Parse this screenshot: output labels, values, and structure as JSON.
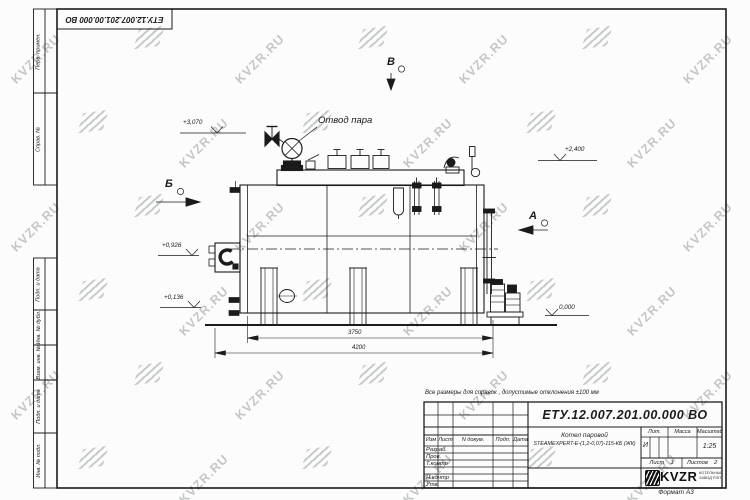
{
  "sheet": {
    "watermark_text": "KVZR.RU",
    "format_label": "Формат  А3"
  },
  "top_stamp": {
    "doc_number": "ЕТУ.12.007.201.00.000  ВО"
  },
  "margin": {
    "labels": [
      "Перв. примен.",
      "Справ. №",
      "Подп. и дата",
      "Инв. № дубл.",
      "Взам. инв. №",
      "Подп. и дата",
      "Инв. № подл."
    ]
  },
  "drawing": {
    "steam_outlet_label": "Отвод пара",
    "elevations": {
      "top": "+3,070",
      "right_top": "+2,400",
      "mid": "+0,926",
      "low": "+0,136",
      "zero": "0,000"
    },
    "dimensions": {
      "inner": "3750",
      "overall": "4200"
    },
    "views": {
      "b": "Б",
      "v": "В",
      "a": "А"
    }
  },
  "note": "Все размеры для справок , допустимые отклонения  ±100  мм",
  "title_block": {
    "doc_number": "ЕТУ.12.007.201.00.000  ВО",
    "rev_headers": [
      "Изм",
      "Лист",
      "N докум.",
      "Подп.",
      "Дата"
    ],
    "row_labels": [
      "Разраб.",
      "Пров.",
      "Т.контр",
      "Н.контр",
      "Утв."
    ],
    "product_name_line1": "Котел паровой",
    "product_name_line2": "STEAMEXPERT-Е-(1,2-0,07)-115-КБ (ЖК)",
    "lit_header": "Лит.",
    "mass_header": "Масса",
    "scale_header": "Масштаб",
    "lit_value": "И",
    "scale_value": "1:25",
    "sheet_label": "Лист",
    "sheet_value": "1",
    "sheets_label": "Листов",
    "sheets_value": "2",
    "company": {
      "logo_text": "KVZR",
      "subtitle_line1": "КОТЕЛЬНЫЙ",
      "subtitle_line2": "ЗАВОД РЭП"
    }
  }
}
